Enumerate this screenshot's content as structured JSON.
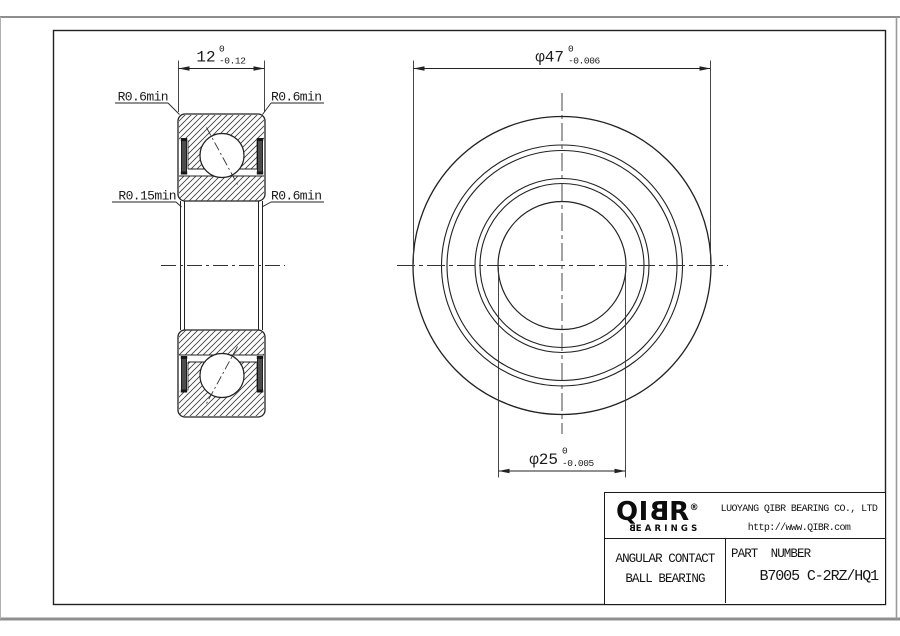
{
  "drawing": {
    "ink_color": "#1f1f1f",
    "centerline_color": "#333333",
    "seal_fill": "#4d4d4d",
    "dimensions": {
      "width": {
        "value": "12",
        "tol_upper": "0",
        "tol_lower": "-0.12"
      },
      "outer_diameter": {
        "value": "φ47",
        "tol_upper": "0",
        "tol_lower": "-0.006"
      },
      "bore_diameter": {
        "value": "φ25",
        "tol_upper": "0",
        "tol_lower": "-0.005"
      }
    },
    "fillet_labels": {
      "top_left": "R0.6min",
      "top_right": "R0.6min",
      "mid_left": "R0.15min",
      "mid_right": "R0.6min"
    }
  },
  "title_block": {
    "logo": {
      "prefix": "QI",
      "mirrored_letter": "B",
      "suffix": "R",
      "registered": "®",
      "sub_prefix": "B",
      "sub_rest": "EARINGS"
    },
    "company": "LUOYANG QIBR BEARING CO., LTD",
    "website": "http://www.QIBR.com",
    "product_line1": "ANGULAR CONTACT",
    "product_line2": "BALL BEARING",
    "part_label": "PART  NUMBER",
    "part_number": "B7005 C-2RZ/HQ1"
  }
}
